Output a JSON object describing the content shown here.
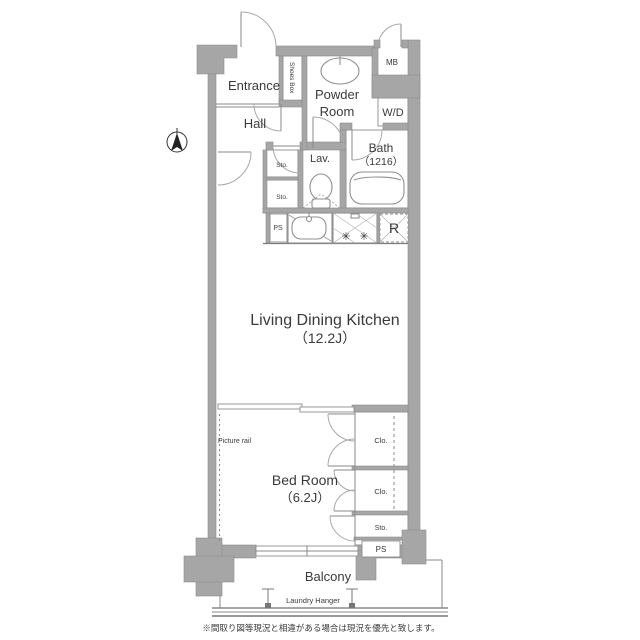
{
  "floorplan": {
    "labels": {
      "entrance": "Entrance",
      "hall": "Hall",
      "shoes_box": "Shoes Box",
      "powder_room_line1": "Powder",
      "powder_room_line2": "Room",
      "meter_box": "MB",
      "washer_dryer": "W/D",
      "bath": "Bath",
      "bath_size": "（1216）",
      "lavatory": "Lav.",
      "storage_upper": "Sto.",
      "storage_lower": "Sto.",
      "pipe_space_kitchen": "PS",
      "refrigerator": "R",
      "ldk": "Living Dining Kitchen",
      "ldk_size": "（12.2J）",
      "bedroom": "Bed Room",
      "bedroom_size": "（6.2J）",
      "picture_rail": "Picture rail",
      "closet_upper": "Clo.",
      "closet_lower": "Clo.",
      "storage_bedroom": "Sto.",
      "pipe_space_bedroom": "PS",
      "balcony": "Balcony",
      "laundry_hanger": "Laundry Hanger"
    },
    "note": "※間取り図等現況と相違がある場合は現況を優先と致します。",
    "colors": {
      "wall": "#a6a6a6",
      "wall_outline": "#8a8a8a",
      "text": "#3a3a3a",
      "background": "#ffffff"
    }
  }
}
